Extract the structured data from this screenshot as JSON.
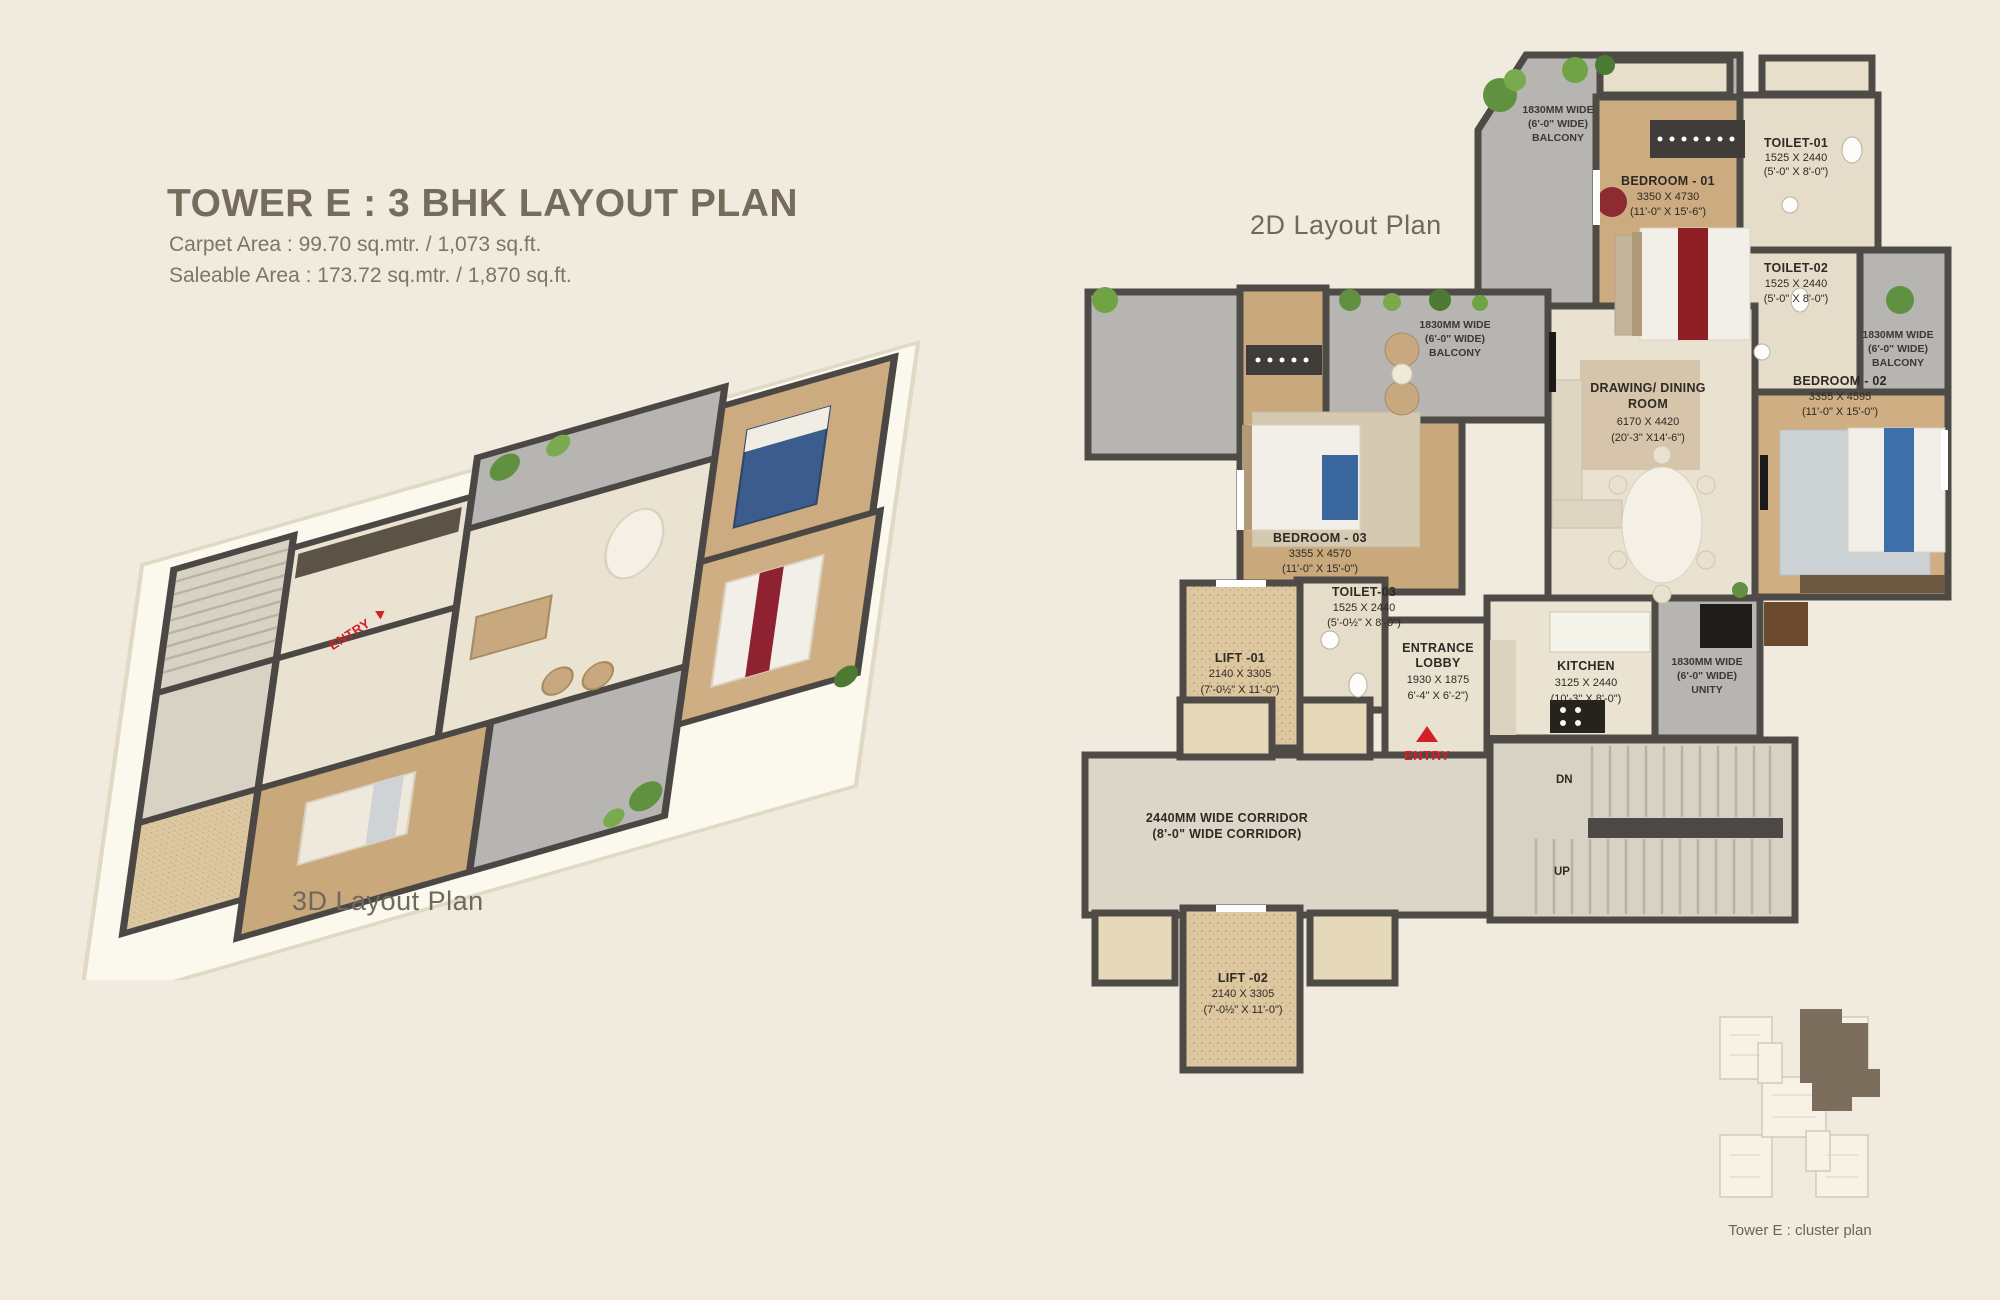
{
  "header": {
    "title": "TOWER E : 3 BHK LAYOUT PLAN",
    "carpet": "Carpet Area : 99.70 sq.mtr. / 1,073 sq.ft.",
    "saleable": "Saleable Area : 173.72 sq.mtr. / 1,870 sq.ft."
  },
  "plan3d": {
    "label": "3D Layout Plan",
    "entry": "ENTRY"
  },
  "plan2d": {
    "label": "2D Layout Plan",
    "entry": "ENTRY",
    "labels": {
      "balcony_top": {
        "l1": "1830MM WIDE",
        "l2": "(6'-0\" WIDE)",
        "l3": "BALCONY"
      },
      "toilet1": {
        "l1": "TOILET-01",
        "l2": "1525 X 2440",
        "l3": "(5'-0\" X 8'-0\")"
      },
      "bedroom1": {
        "l1": "BEDROOM - 01",
        "l2": "3350 X 4730",
        "l3": "(11'-0\" X 15'-6\")"
      },
      "toilet2": {
        "l1": "TOILET-02",
        "l2": "1525 X 2440",
        "l3": "(5'-0\" X 8'-0\")"
      },
      "balcony_mid": {
        "l1": "1830MM WIDE",
        "l2": "(6'-0\" WIDE)",
        "l3": "BALCONY"
      },
      "balcony_right": {
        "l1": "1830MM WIDE",
        "l2": "(6'-0\" WIDE)",
        "l3": "BALCONY"
      },
      "drawing": {
        "l1": "DRAWING/ DINING",
        "l2": "ROOM",
        "l3": "6170 X 4420",
        "l4": "(20'-3\" X14'-6\")"
      },
      "bedroom2": {
        "l1": "BEDROOM - 02",
        "l2": "3355 X 4595",
        "l3": "(11'-0\" X 15'-0\")"
      },
      "bedroom3": {
        "l1": "BEDROOM - 03",
        "l2": "3355 X 4570",
        "l3": "(11'-0\" X 15'-0\")"
      },
      "toilet3": {
        "l1": "TOILET-03",
        "l2": "1525 X 2440",
        "l3": "(5'-0½\" X 8'-0\")"
      },
      "lift1": {
        "l1": "LIFT -01",
        "l2": "2140 X 3305",
        "l3": "(7'-0½\" X 11'-0\")"
      },
      "lobby": {
        "l1": "ENTRANCE",
        "l2": "LOBBY",
        "l3": "1930 X 1875",
        "l4": "6'-4\" X 6'-2\")"
      },
      "kitchen": {
        "l1": "KITCHEN",
        "l2": "3125 X 2440",
        "l3": "(10'-3\" X 8'-0\")"
      },
      "utility": {
        "l1": "1830MM WIDE",
        "l2": "(6'-0\" WIDE)",
        "l3": "UNITY"
      },
      "corridor": {
        "l1": "2440MM WIDE CORRIDOR",
        "l2": "(8'-0\"  WIDE CORRIDOR)"
      },
      "dn": "DN",
      "up": "UP",
      "lift2": {
        "l1": "LIFT -02",
        "l2": "2140 X 3305",
        "l3": "(7'-0½\" X 11'-0\")"
      }
    }
  },
  "cluster": {
    "label": "Tower E : cluster plan"
  },
  "colors": {
    "background": "#f0ebde",
    "accent_red": "#d41f26",
    "wall": "#4e4b47",
    "wood_floor": "#cdab80",
    "tile_gray": "#b7b5b2",
    "marble": "#e9e2d1",
    "lift_floor": "#dcc7a0",
    "title_text": "#756c5c",
    "cluster_highlight": "#7b6e5d"
  }
}
